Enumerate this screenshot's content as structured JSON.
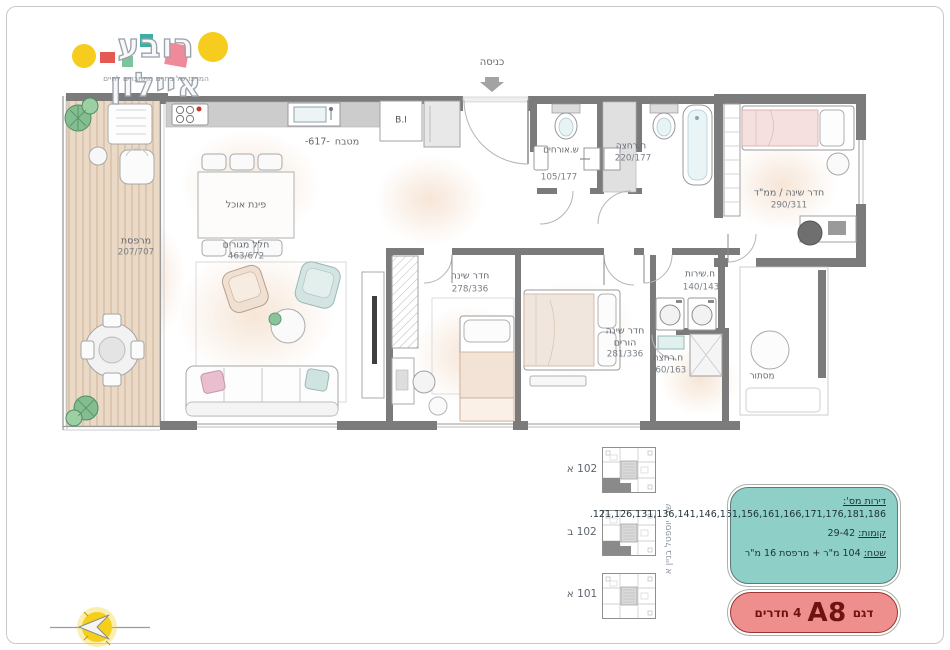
{
  "logo": {
    "title": "רובע איילון",
    "tagline": "המרכז של בת ים מתחברים לחיים"
  },
  "plan": {
    "entrance": "כניסה",
    "kitchen": "מטבח",
    "kitchen_dim": "-617-",
    "built_in": "B.I",
    "dining": "פינת אוכל",
    "living": "חלל מגורים",
    "living_size": "463/672",
    "balcony": "מרפסת",
    "balcony_size": "207/707",
    "bedroom": "חדר שינה",
    "bedroom_size": "278/336",
    "parents_line1": "חדר שינה",
    "parents_line2": "הורים",
    "parents_size": "281/336",
    "mamad": "חדר שינה / ממ\"ד",
    "mamad_size": "290/311",
    "guest_wc": "ש.אורחים",
    "guest_wc_size": "105/177",
    "bathroom": "ח.רחצה",
    "bathroom_size": "220/177",
    "utility": "ח.שירות",
    "utility_size": "140/143",
    "shower_room": "ח.רחצה",
    "shower_room_size": "160/163",
    "concealment": "מסתור"
  },
  "key_plans": {
    "items": [
      {
        "label": "102 א",
        "highlighted": true
      },
      {
        "label": "102 ב",
        "highlighted": true
      },
      {
        "label": "101 א",
        "highlighted": false
      }
    ],
    "street_caption": "שד' יוספטל בניין א"
  },
  "info_box": {
    "apartments_label": "דירות מס':",
    "apartments_value": "121,126,131,136,141,146,151,156,161,166,171,176,181,186.",
    "floors_label": "קומות:",
    "floors_value": "29-42",
    "area_label": "שטח:",
    "area_value": "104 מ\"ר + מרפסת 16 מ\"ר"
  },
  "model_box": {
    "label": "דגם",
    "model": "A8",
    "rooms": "4 חדרים"
  },
  "colors": {
    "wall": "#7B7B7B",
    "teal_box": "#8ED0C7",
    "pink_box": "#EF8F8D",
    "logo_yellow": "#F6CD1E",
    "logo_pink": "#EF8A9B",
    "logo_teal": "#3AAFA3",
    "logo_red": "#E25A52",
    "logo_green": "#7CC49B",
    "compass_yellow": "#F6CF1B",
    "deck": "#E9D8C5"
  }
}
